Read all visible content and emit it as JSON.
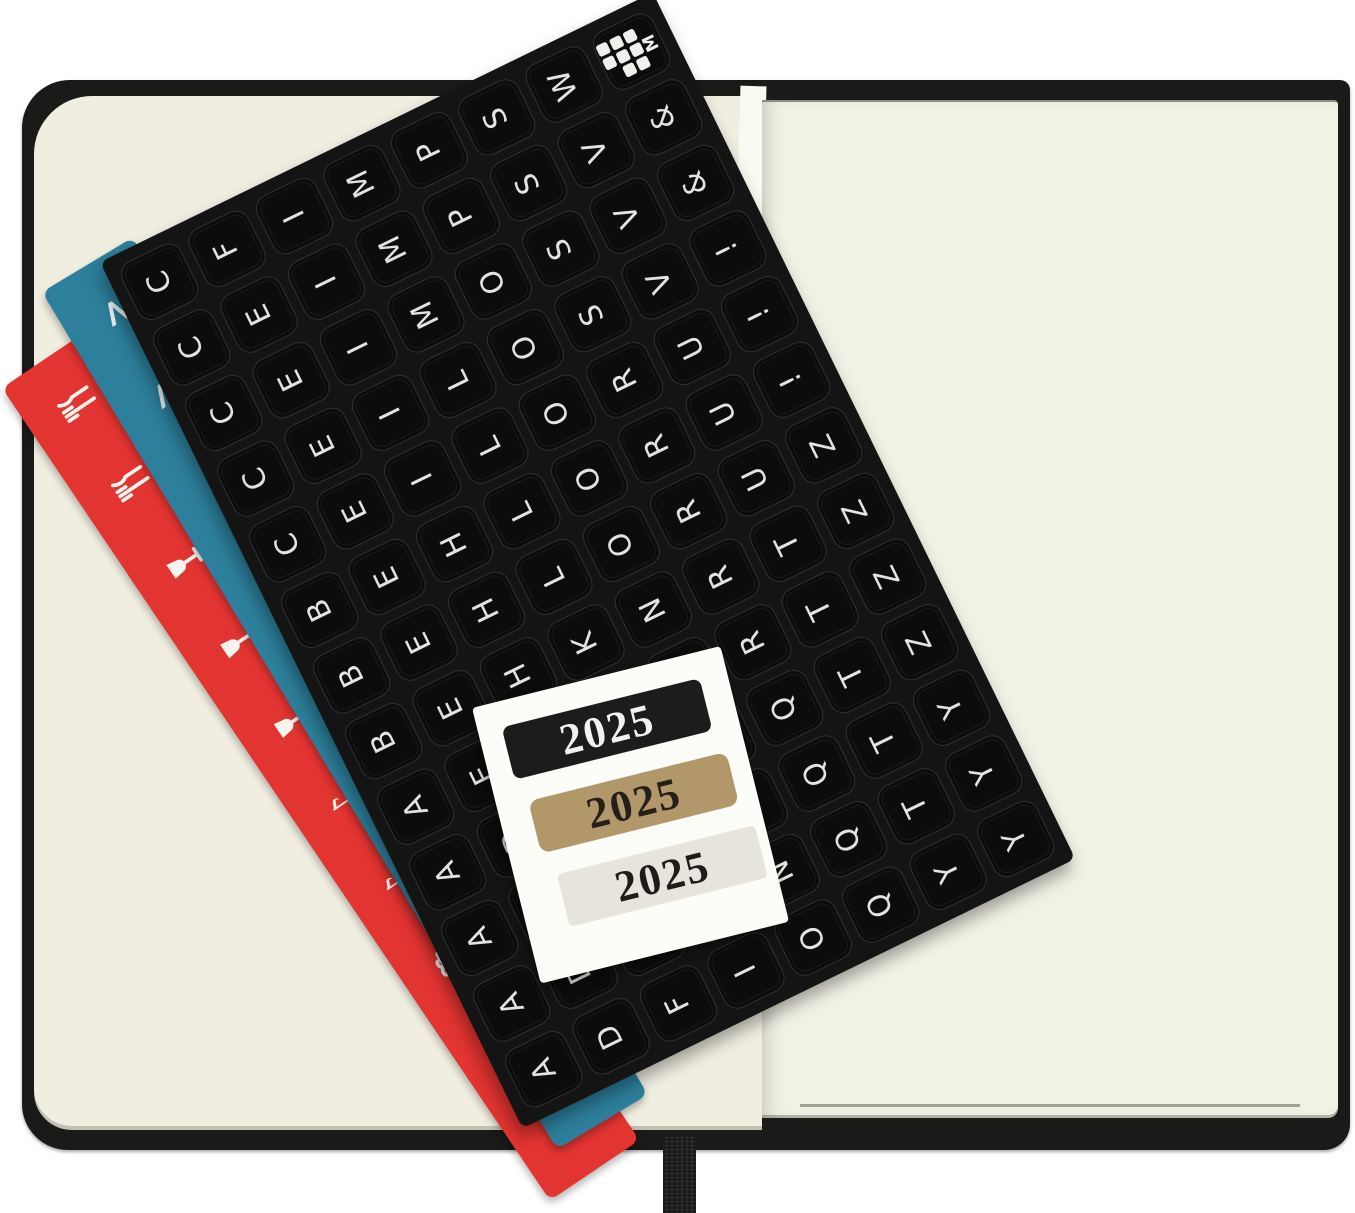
{
  "scene": {
    "type": "product-photo",
    "subject": "open planner notebook with sticker sheets and 2025 year stickers"
  },
  "colors": {
    "background": "#ffffff",
    "cover_black": "#1a1a18",
    "page_cream_left": "#f0eee1",
    "page_cream_right": "#f2f1e5",
    "sheet_black": "#141414",
    "strip_red": "#e23431",
    "strip_teal": "#2d7f9b",
    "card_white": "#fcfcf8",
    "sticker_gold": "#b2976b",
    "sticker_pale": "#e7e5db"
  },
  "letter_sheet": {
    "logo_letter": "M",
    "grid": [
      [
        "C",
        "F",
        "I",
        "M",
        "P",
        "S",
        "W",
        "LOGO"
      ],
      [
        "C",
        "E",
        "I",
        "M",
        "P",
        "S",
        "V",
        "&"
      ],
      [
        "C",
        "E",
        "I",
        "M",
        "O",
        "S",
        "V",
        "&"
      ],
      [
        "C",
        "E",
        "I",
        "L",
        "O",
        "S",
        "V",
        "!"
      ],
      [
        "C",
        "E",
        "I",
        "L",
        "O",
        "R",
        "U",
        "!"
      ],
      [
        "B",
        "E",
        "H",
        "L",
        "O",
        "R",
        "U",
        "!"
      ],
      [
        "B",
        "E",
        "H",
        "L",
        "O",
        "R",
        "U",
        "Z"
      ],
      [
        "B",
        "E",
        "H",
        "K",
        "N",
        "R",
        "T",
        "Z"
      ],
      [
        "A",
        "E",
        "H",
        "K",
        "N",
        "R",
        "T",
        "Z"
      ],
      [
        "A",
        "D",
        "F",
        "K",
        "N",
        "Q",
        "T",
        "Z"
      ],
      [
        "A",
        "D",
        "F",
        "K",
        "N",
        "Q",
        "T",
        "Y"
      ],
      [
        "A",
        "D",
        "F",
        "I",
        "N",
        "Q",
        "T",
        "Y"
      ],
      [
        "A",
        "D",
        "F",
        "I",
        "O",
        "Q",
        "Y",
        "Y"
      ]
    ]
  },
  "strips": {
    "red": {
      "color": "#e23431",
      "icons": [
        "fork-knife",
        "fork-knife",
        "wine-glass",
        "wine-glass",
        "wine-glass",
        "music-note",
        "music-note",
        "gift",
        "firework",
        "firework"
      ]
    },
    "teal": {
      "color": "#2d7f9b",
      "icons": [
        "chevron",
        "chevron",
        "chevron",
        "magnifier",
        "magnifier",
        "laptop",
        "laptop",
        "exclamation",
        "exclamation",
        "laptop"
      ]
    }
  },
  "year_card": {
    "stickers": [
      {
        "text": "2025",
        "bg": "#1c1c1c",
        "fg": "#f2f2f0"
      },
      {
        "text": "2025",
        "bg": "#b2976b",
        "fg": "#241f18"
      },
      {
        "text": "2025",
        "bg": "#e7e5db",
        "fg": "#1d1c18"
      }
    ]
  }
}
